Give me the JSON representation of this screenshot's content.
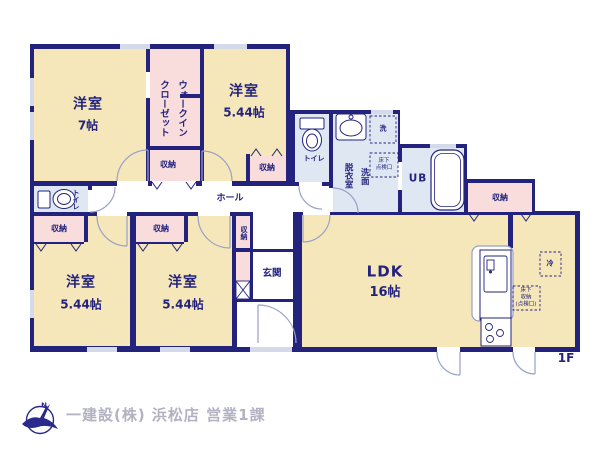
{
  "meta": {
    "floor": "1F"
  },
  "footer": {
    "company": "一建設(株) 浜松店 営業1課",
    "logo_letter": "N"
  },
  "rooms": {
    "bedroom7": {
      "name": "洋室",
      "size": "7帖"
    },
    "bedroom544_top": {
      "name": "洋室",
      "size": "5.44帖"
    },
    "bedroom544_left": {
      "name": "洋室",
      "size": "5.44帖"
    },
    "bedroom544_mid": {
      "name": "洋室",
      "size": "5.44帖"
    },
    "ldk": {
      "name": "LDK",
      "size": "16帖"
    },
    "wic": {
      "line1": "ウォークイン",
      "line2": "クローゼット"
    },
    "washroom": {
      "line1": "洗面",
      "line2": "脱衣室"
    },
    "ub": "UB",
    "hall": "ホール",
    "genkan": "玄関",
    "toilet": "トイレ"
  },
  "labels": {
    "storage": "収納",
    "washer": "洗",
    "fridge": "冷",
    "underfloor_inspection": {
      "line1": "床下",
      "line2": "点検口"
    },
    "underfloor_storage": {
      "line1": "床下",
      "line2": "収納",
      "line3": "(点検口)"
    }
  },
  "colors": {
    "wall": "#23237e",
    "room_cream": "#f6e7bb",
    "room_pink": "#f9dcdc",
    "room_blue": "#dfe7f3",
    "door_arc": "#98a1c8",
    "footer_text": "#b2b2c2"
  }
}
